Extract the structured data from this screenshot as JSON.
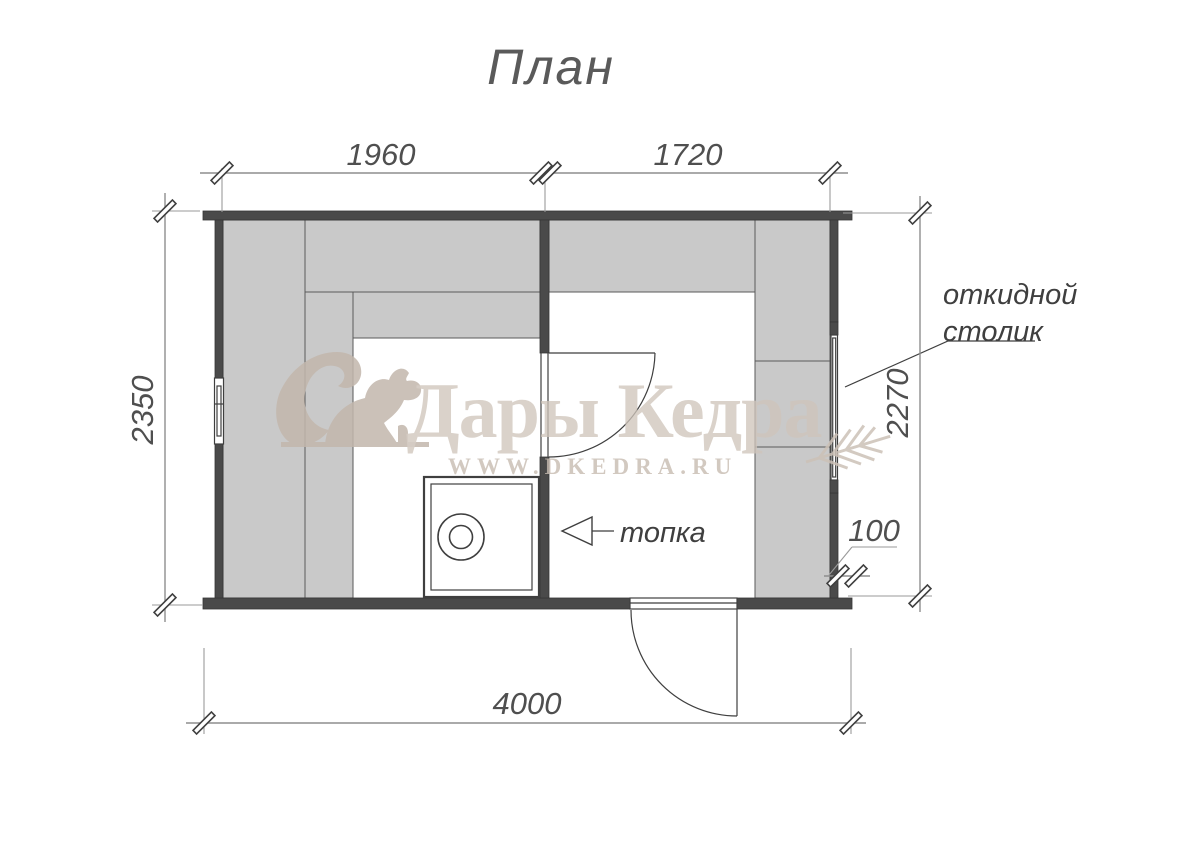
{
  "page": {
    "title": "План"
  },
  "dimensions": {
    "room_left_width": "1960",
    "room_right_width": "1720",
    "left_height": "2350",
    "right_height": "2270",
    "total_width": "4000",
    "wall_offset": "100"
  },
  "annotations": {
    "folding_table_line1": "откидной",
    "folding_table_line2": "столик",
    "firebox": "топка"
  },
  "watermark": {
    "brand": "Дары Кедра",
    "url": "WWW.DKEDRA.RU"
  },
  "colors": {
    "wall": "#4a4a4a",
    "bench": "#c9c9c9",
    "dimension_line": "#8e8e8e",
    "dimension_text": "#4f4f4f",
    "watermark": "#cfc5bb",
    "background": "#ffffff"
  }
}
